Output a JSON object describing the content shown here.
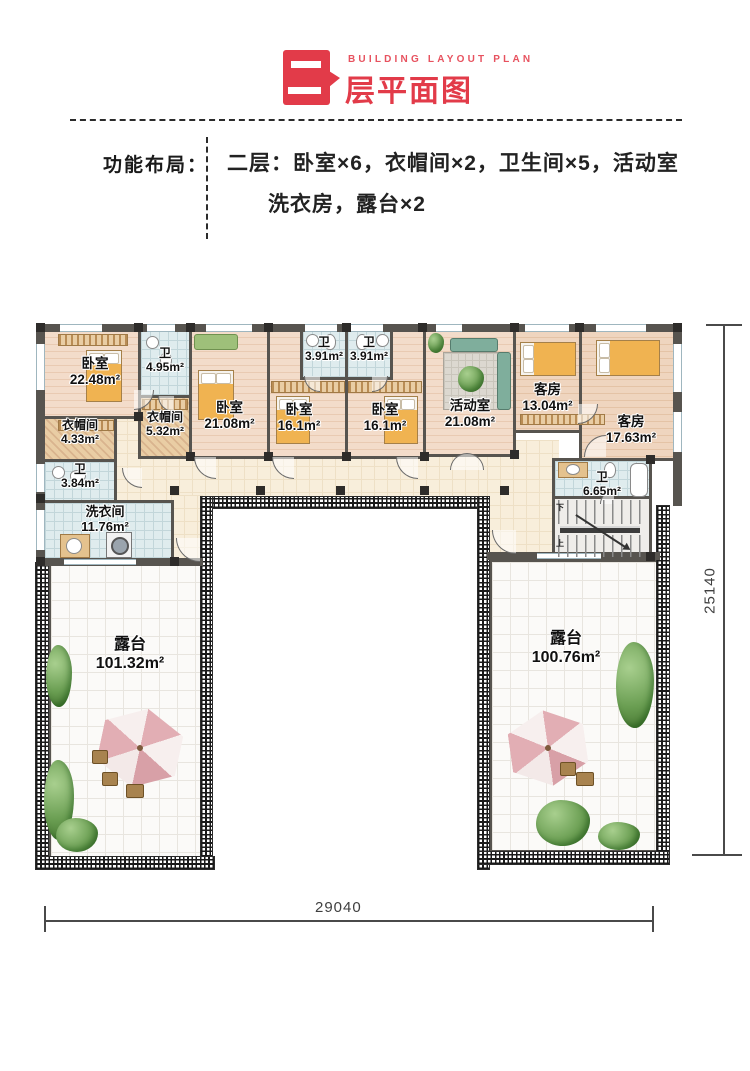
{
  "header": {
    "eyebrow": "BUILDING LAYOUT PLAN",
    "title": "层平面图",
    "badge_glyph": "二"
  },
  "summary": {
    "label": "功能布局：",
    "line1": "二层：卧室×6，衣帽间×2，卫生间×5，活动室",
    "line2": "洗衣房，露台×2"
  },
  "plan": {
    "rooms": [
      {
        "name": "卧室",
        "area": "22.48m²"
      },
      {
        "name": "卫",
        "area": "4.95m²"
      },
      {
        "name": "衣帽间",
        "area": "4.33m²"
      },
      {
        "name": "衣帽间",
        "area": "5.32m²"
      },
      {
        "name": "卫",
        "area": "3.84m²"
      },
      {
        "name": "卧室",
        "area": "21.08m²"
      },
      {
        "name": "卫",
        "area": "3.91m²"
      },
      {
        "name": "卫",
        "area": "3.91m²"
      },
      {
        "name": "卧室",
        "area": "16.1m²"
      },
      {
        "name": "卧室",
        "area": "16.1m²"
      },
      {
        "name": "活动室",
        "area": "21.08m²"
      },
      {
        "name": "客房",
        "area": "13.04m²"
      },
      {
        "name": "客房",
        "area": "17.63m²"
      },
      {
        "name": "卫",
        "area": "6.65m²"
      },
      {
        "name": "洗衣间",
        "area": "11.76m²"
      },
      {
        "name": "露台",
        "area": "101.32m²"
      },
      {
        "name": "露台",
        "area": "100.76m²"
      }
    ],
    "stairs": {
      "down": "下",
      "up": "上"
    },
    "dimensions": {
      "width": "29040",
      "height": "25140"
    }
  },
  "colors": {
    "accent_red": "#e23b49",
    "wall_gray": "#57544f"
  }
}
